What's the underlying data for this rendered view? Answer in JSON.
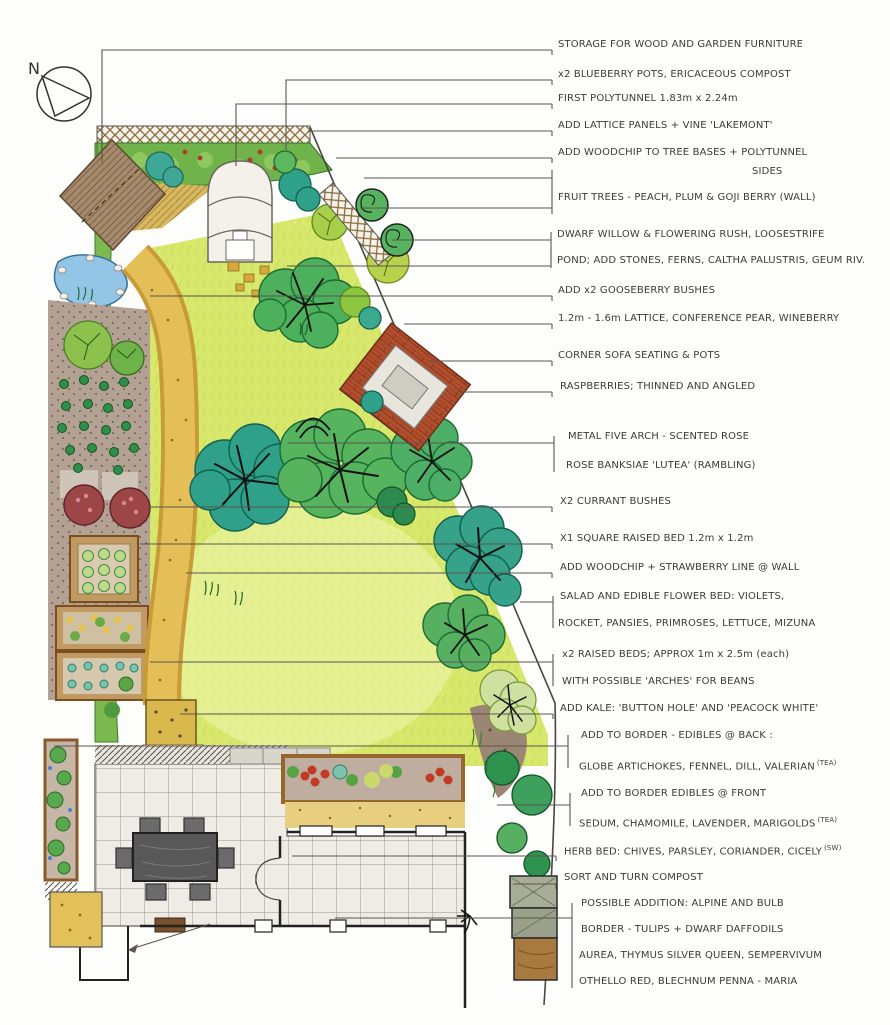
{
  "compass": {
    "label": "N"
  },
  "colors": {
    "lawn": "#d8e86d",
    "lawn_light": "#eef5ae",
    "hedge": "#7cb94f",
    "tree_green": "#56b45e",
    "tree_teal": "#2fa08a",
    "woodchip": "#e4bf58",
    "soil": "#b3a294",
    "pond": "#93c6e6",
    "brick": "#b14e2d",
    "patio": "#eeece4",
    "shed": "#a58a6c",
    "ink": "#3f3b36"
  },
  "annotations": [
    {
      "text": "STORAGE FOR WOOD AND GARDEN FURNITURE"
    },
    {
      "text": "x2 BLUEBERRY POTS, ERICACEOUS COMPOST"
    },
    {
      "text": "FIRST POLYTUNNEL 1.83m x 2.24m"
    },
    {
      "text": "ADD LATTICE PANELS + VINE 'LAKEMONT'"
    },
    {
      "text": "ADD WOODCHIP TO TREE BASES + POLYTUNNEL"
    },
    {
      "text": "SIDES"
    },
    {
      "text": "FRUIT TREES - PEACH, PLUM & GOJI BERRY (WALL)"
    },
    {
      "text": "DWARF WILLOW & FLOWERING RUSH, LOOSESTRIFE"
    },
    {
      "text": "POND; ADD STONES, FERNS, CALTHA PALUSTRIS, GEUM RIV."
    },
    {
      "text": "ADD x2 GOOSEBERRY BUSHES"
    },
    {
      "text": "1.2m - 1.6m LATTICE, CONFERENCE PEAR, WINEBERRY"
    },
    {
      "text": "CORNER SOFA SEATING & POTS"
    },
    {
      "text": "RASPBERRIES; THINNED AND ANGLED"
    },
    {
      "text": "METAL FIVE ARCH - SCENTED ROSE"
    },
    {
      "text": "ROSE BANKSIAE 'LUTEA' (RAMBLING)"
    },
    {
      "text": "X2 CURRANT BUSHES"
    },
    {
      "text": "X1 SQUARE RAISED BED 1.2m x 1.2m"
    },
    {
      "text": "ADD WOODCHIP + STRAWBERRY LINE @ WALL"
    },
    {
      "text": "SALAD AND EDIBLE FLOWER BED: VIOLETS,"
    },
    {
      "text": "ROCKET, PANSIES, PRIMROSES, LETTUCE, MIZUNA"
    },
    {
      "text": "x2 RAISED BEDS; APPROX 1m x 2.5m (each)"
    },
    {
      "text": "WITH POSSIBLE 'ARCHES' FOR BEANS"
    },
    {
      "text": "ADD KALE: 'BUTTON HOLE' AND 'PEACOCK WHITE'"
    },
    {
      "text": "ADD TO BORDER - EDIBLES @ BACK :"
    },
    {
      "text": "GLOBE ARTICHOKES, FENNEL, DILL, VALERIAN",
      "sup": "(TEA)"
    },
    {
      "text": "ADD TO BORDER EDIBLES @ FRONT"
    },
    {
      "text": "SEDUM, CHAMOMILE, LAVENDER, MARIGOLDS",
      "sup": "(TEA)"
    },
    {
      "text": "HERB BED: CHIVES, PARSLEY, CORIANDER, CICELY",
      "sup": "(SW)"
    },
    {
      "text": "SORT AND TURN COMPOST"
    },
    {
      "text": "POSSIBLE ADDITION: ALPINE AND BULB"
    },
    {
      "text": "BORDER - TULIPS + DWARF DAFFODILS"
    },
    {
      "text": "AUREA, THYMUS SILVER QUEEN, SEMPERVIVUM"
    },
    {
      "text": "OTHELLO RED, BLECHNUM PENNA - MARIA"
    }
  ]
}
